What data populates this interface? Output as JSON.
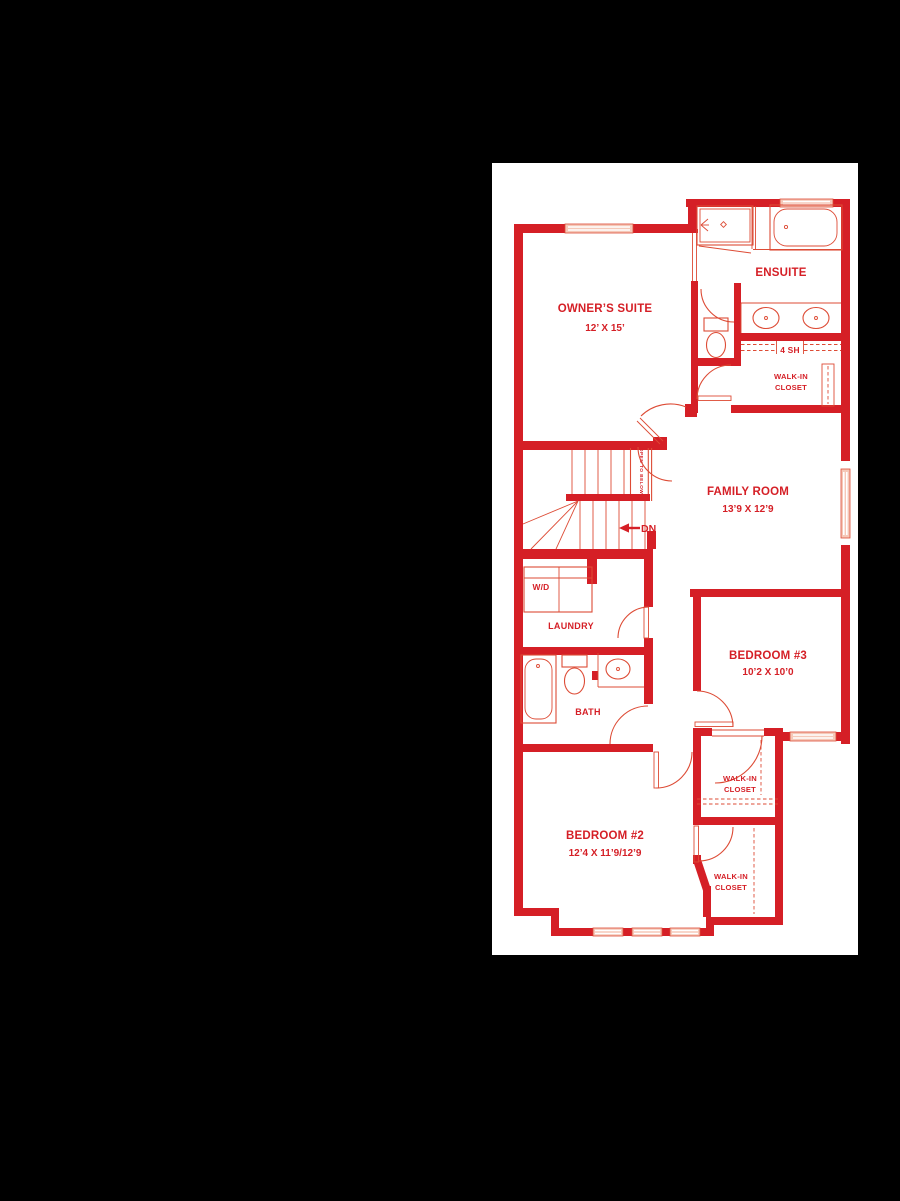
{
  "colors": {
    "background": "#000000",
    "panel": "#ffffff",
    "wall": "#d51f26",
    "line": "#dd4b35",
    "window_fill": "#f5c8b8"
  },
  "labels": {
    "owners_suite": {
      "name": "OWNER’S SUITE",
      "dims": "12’ X 15’"
    },
    "ensuite": {
      "name": "ENSUITE"
    },
    "shelf": "4 SH",
    "walk_in": "WALK-IN",
    "closet": "CLOSET",
    "family_room": {
      "name": "FAMILY ROOM",
      "dims": "13’9 X 12’9"
    },
    "stairs": {
      "dn": "DN",
      "open_to_below": "OPEN TO BELOW"
    },
    "laundry": {
      "name": "LAUNDRY",
      "unit": "W/D"
    },
    "bath": {
      "name": "BATH"
    },
    "bedroom3": {
      "name": "BEDROOM #3",
      "dims": "10’2 X 10’0"
    },
    "bedroom2": {
      "name": "BEDROOM #2",
      "dims": "12’4 X 11’9/12’9"
    }
  }
}
